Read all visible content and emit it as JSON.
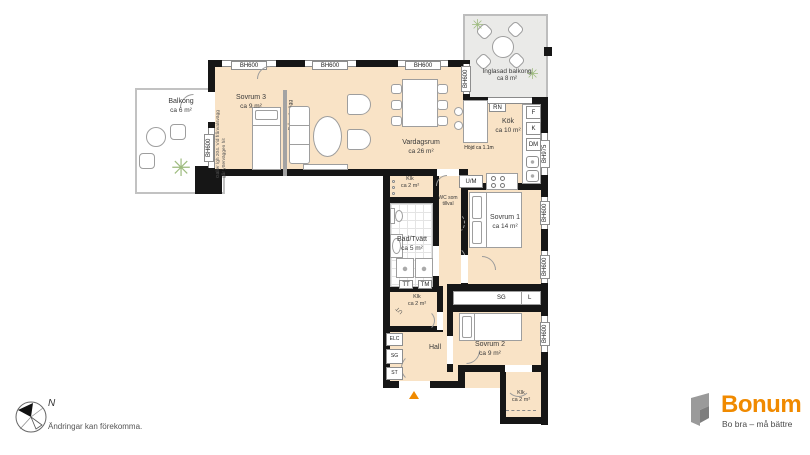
{
  "colors": {
    "brand_orange": "#F08A00",
    "floor_peach": "#F9E3C6"
  },
  "rooms": {
    "balkong": {
      "name": "Balkong",
      "area": "ca 6 m²"
    },
    "sovrum3": {
      "name": "Sovrum 3",
      "area": "ca 9 m²"
    },
    "vardagsrum": {
      "name": "Vardagsrum",
      "area": "ca 26 m²"
    },
    "kok": {
      "name": "Kök",
      "area": "ca 10 m²"
    },
    "inglasad_balkong": {
      "name": "Inglasad balkong",
      "area": "ca 8 m²"
    },
    "klk_ovre": {
      "name": "Klk",
      "area": "ca 2 m²"
    },
    "wc_tillval": {
      "name": "WC som tillval"
    },
    "bad_tvatt": {
      "name": "Bad/Tvätt",
      "area": "ca 5 m²"
    },
    "sovrum1": {
      "name": "Sovrum 1",
      "area": "ca 14 m²"
    },
    "klk_mellan": {
      "name": "Klk",
      "area": "ca 2 m²"
    },
    "hall": {
      "name": "Hall"
    },
    "sovrum2": {
      "name": "Sovrum 2",
      "area": "ca 9 m²"
    },
    "klk_nedre": {
      "name": "Klk",
      "area": "ca 2 m²"
    }
  },
  "fixtures": {
    "um": "U/M",
    "f": "F",
    "k": "K",
    "dm": "DM",
    "tt": "TT",
    "tm": "TM",
    "elc": "ELC",
    "sg": "SG",
    "st": "ST",
    "l": "L",
    "rn": "RN",
    "ut": "UT"
  },
  "windows": {
    "bh600": "BH600",
    "bh975": "BH975"
  },
  "notes": {
    "hojd": "Höjd ca 1.1m",
    "franvalsvagg": "Frånvalsvägg",
    "franval_note": "Gäller lgh 204. Vid frånvalsvägg går ytterväggen hit",
    "disclaimer": "Ändringar kan förekomma.",
    "north": "N"
  },
  "logo": {
    "name": "Bonum",
    "tagline": "Bo bra – må bättre"
  }
}
